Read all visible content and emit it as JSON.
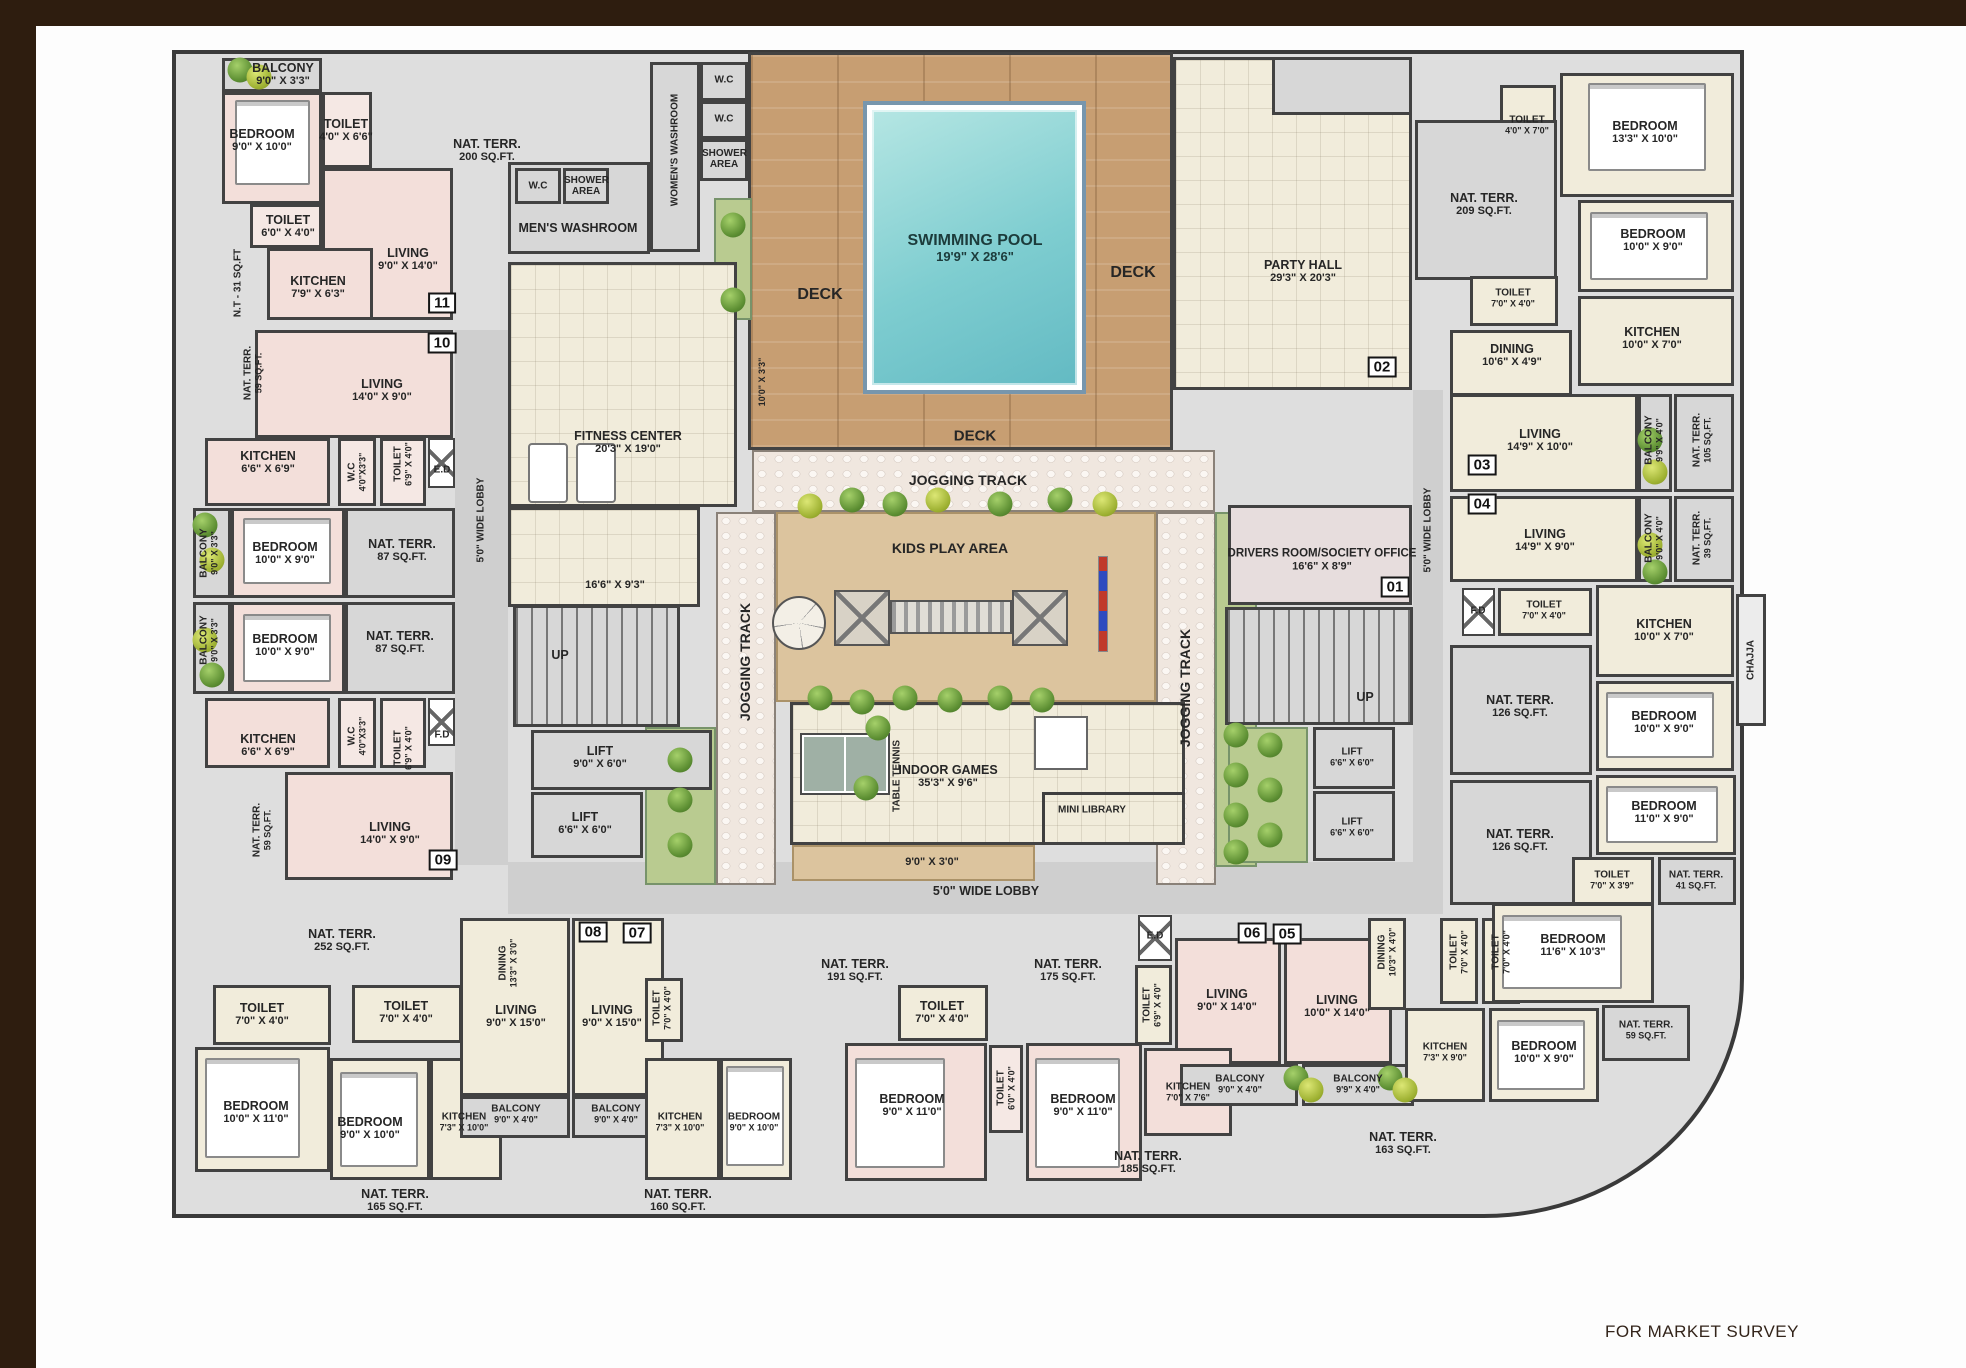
{
  "footer": "FOR MARKET SURVEY",
  "B": [
    "11",
    "10",
    "09",
    "08",
    "07",
    "06",
    "05",
    "04",
    "03",
    "02",
    "01"
  ],
  "L": [
    {
      "t": "BALCONY",
      "d": "9'0\" X 3'3\""
    },
    {
      "t": "BEDROOM",
      "d": "9'0\" X 10'0\""
    },
    {
      "t": "TOILET",
      "d": "4'0\" X 6'6\""
    },
    {
      "t": "NAT. TERR.",
      "d": "200 SQ.FT."
    },
    {
      "t": "W.C",
      "d": ""
    },
    {
      "t": "SHOWER AREA",
      "d": ""
    },
    {
      "t": "MEN'S WASHROOM",
      "d": ""
    },
    {
      "t": "TOILET",
      "d": "6'0\" X 4'0\""
    },
    {
      "t": "KITCHEN",
      "d": "7'9\" X 6'3\""
    },
    {
      "t": "LIVING",
      "d": "9'0\" X 14'0\""
    },
    {
      "t": "N.T - 31 SQ.FT",
      "d": ""
    },
    {
      "t": "WOMEN'S WASHROOM",
      "d": ""
    },
    {
      "t": "W.C",
      "d": ""
    },
    {
      "t": "W.C",
      "d": ""
    },
    {
      "t": "SHOWER AREA",
      "d": ""
    },
    {
      "t": "DECK",
      "d": ""
    },
    {
      "t": "SWIMMING POOL",
      "d": "19'9\" X 28'6\""
    },
    {
      "t": "DECK",
      "d": ""
    },
    {
      "t": "DECK",
      "d": ""
    },
    {
      "t": "PARTY HALL",
      "d": "29'3\" X 20'3\""
    },
    {
      "t": "JOGGING TRACK",
      "d": ""
    },
    {
      "t": "KIDS PLAY AREA",
      "d": ""
    },
    {
      "t": "JOGGING TRACK",
      "d": ""
    },
    {
      "t": "JOGGING TRACK",
      "d": ""
    },
    {
      "t": "FITNESS CENTER",
      "d": "20'3\" X 19'0\""
    },
    {
      "t": "",
      "d": "16'6\" X 9'3\""
    },
    {
      "t": "",
      "d": "10'0\" X 3'3\""
    },
    {
      "t": "5'0\" WIDE LOBBY",
      "d": ""
    },
    {
      "t": "UP",
      "d": ""
    },
    {
      "t": "LIFT",
      "d": "9'0\" X 6'0\""
    },
    {
      "t": "LIFT",
      "d": "6'6\" X 6'0\""
    },
    {
      "t": "TABLE TENNIS",
      "d": ""
    },
    {
      "t": "INDOOR GAMES",
      "d": "35'3\" X 9'6\""
    },
    {
      "t": "MINI LIBRARY",
      "d": ""
    },
    {
      "t": "",
      "d": "9'0\" X 3'0\""
    },
    {
      "t": "5'0\" WIDE LOBBY",
      "d": ""
    },
    {
      "t": "DRIVERS ROOM/SOCIETY OFFICE",
      "d": "16'6\" X 8'9\""
    },
    {
      "t": "UP",
      "d": ""
    },
    {
      "t": "LIFT",
      "d": "6'6\" X 6'0\""
    },
    {
      "t": "LIFT",
      "d": "6'6\" X 6'0\""
    },
    {
      "t": "5'0\" WIDE LOBBY",
      "d": ""
    },
    {
      "t": "NAT. TERR.",
      "d": "59 SQ.FT."
    },
    {
      "t": "LIVING",
      "d": "14'0\" X 9'0\""
    },
    {
      "t": "KITCHEN",
      "d": "6'6\" X 6'9\""
    },
    {
      "t": "W.C",
      "d": "4'0\"X3'3\""
    },
    {
      "t": "TOILET",
      "d": "6'9\" X 4'0\""
    },
    {
      "t": "E.D",
      "d": ""
    },
    {
      "t": "BALCONY",
      "d": "9'0\" X 3'3\""
    },
    {
      "t": "BEDROOM",
      "d": "10'0\" X 9'0\""
    },
    {
      "t": "NAT. TERR.",
      "d": "87 SQ.FT."
    },
    {
      "t": "BALCONY",
      "d": "9'0\" X 3'3\""
    },
    {
      "t": "BEDROOM",
      "d": "10'0\" X 9'0\""
    },
    {
      "t": "NAT. TERR.",
      "d": "87 SQ.FT."
    },
    {
      "t": "KITCHEN",
      "d": "6'6\" X 6'9\""
    },
    {
      "t": "W.C",
      "d": "4'0\"X3'3\""
    },
    {
      "t": "TOILET",
      "d": "6'9\" X 4'0\""
    },
    {
      "t": "F.D",
      "d": ""
    },
    {
      "t": "NAT. TERR.",
      "d": "59 SQ.FT."
    },
    {
      "t": "LIVING",
      "d": "14'0\" X 9'0\""
    },
    {
      "t": "NAT. TERR.",
      "d": "252 SQ.FT."
    },
    {
      "t": "TOILET",
      "d": "7'0\" X 4'0\""
    },
    {
      "t": "TOILET",
      "d": "7'0\" X 4'0\""
    },
    {
      "t": "BEDROOM",
      "d": "10'0\" X 11'0\""
    },
    {
      "t": "BEDROOM",
      "d": "9'0\" X 10'0\""
    },
    {
      "t": "KITCHEN",
      "d": "7'3\" X 10'0\""
    },
    {
      "t": "NAT. TERR.",
      "d": "165 SQ.FT."
    },
    {
      "t": "DINING",
      "d": "13'3\" X 3'0\""
    },
    {
      "t": "LIVING",
      "d": "9'0\" X 15'0\""
    },
    {
      "t": "LIVING",
      "d": "9'0\" X 15'0\""
    },
    {
      "t": "BALCONY",
      "d": "9'0\" X 4'0\""
    },
    {
      "t": "BALCONY",
      "d": "9'0\" X 4'0\""
    },
    {
      "t": "NAT. TERR.",
      "d": "160 SQ.FT."
    },
    {
      "t": "TOILET",
      "d": "7'0\" X 4'0\""
    },
    {
      "t": "KITCHEN",
      "d": "7'3\" X 10'0\""
    },
    {
      "t": "BEDROOM",
      "d": "9'0\" X 10'0\""
    },
    {
      "t": "NAT. TERR.",
      "d": "191 SQ.FT."
    },
    {
      "t": "NAT. TERR.",
      "d": "175 SQ.FT."
    },
    {
      "t": "TOILET",
      "d": "7'0\" X 4'0\""
    },
    {
      "t": "E.D",
      "d": ""
    },
    {
      "t": "TOILET",
      "d": "6'9\" X 4'0\""
    },
    {
      "t": "LIVING",
      "d": "9'0\" X 14'0\""
    },
    {
      "t": "LIVING",
      "d": "10'0\" X 14'0\""
    },
    {
      "t": "BEDROOM",
      "d": "9'0\" X 11'0\""
    },
    {
      "t": "TOILET",
      "d": "6'0\" X 4'0\""
    },
    {
      "t": "BEDROOM",
      "d": "9'0\" X 11'0\""
    },
    {
      "t": "KITCHEN",
      "d": "7'0\" X 7'6\""
    },
    {
      "t": "BALCONY",
      "d": "9'0\" X 4'0\""
    },
    {
      "t": "BALCONY",
      "d": "9'9\" X 4'0\""
    },
    {
      "t": "NAT. TERR.",
      "d": "185 SQ.FT."
    },
    {
      "t": "DINING",
      "d": "10'3\" X 4'0\""
    },
    {
      "t": "TOILET",
      "d": "7'0\" X 4'0\""
    },
    {
      "t": "TOILET",
      "d": "7'0\" X 4'0\""
    },
    {
      "t": "BEDROOM",
      "d": "11'6\" X 10'3\""
    },
    {
      "t": "KITCHEN",
      "d": "7'3\" X 9'0\""
    },
    {
      "t": "BEDROOM",
      "d": "10'0\" X 9'0\""
    },
    {
      "t": "NAT. TERR.",
      "d": "59 SQ.FT."
    },
    {
      "t": "NAT. TERR.",
      "d": "163 SQ.FT."
    },
    {
      "t": "TOILET",
      "d": "4'0\" X 7'0\""
    },
    {
      "t": "BEDROOM",
      "d": "13'3\" X 10'0\""
    },
    {
      "t": "NAT. TERR.",
      "d": "209 SQ.FT."
    },
    {
      "t": "BEDROOM",
      "d": "10'0\" X 9'0\""
    },
    {
      "t": "TOILET",
      "d": "7'0\" X 4'0\""
    },
    {
      "t": "DINING",
      "d": "10'6\" X 4'9\""
    },
    {
      "t": "KITCHEN",
      "d": "10'0\" X 7'0\""
    },
    {
      "t": "LIVING",
      "d": "14'9\" X 10'0\""
    },
    {
      "t": "BALCONY",
      "d": "9'9\" X 4'0\""
    },
    {
      "t": "NAT. TERR.",
      "d": "105 SQ.FT."
    },
    {
      "t": "LIVING",
      "d": "14'9\" X 9'0\""
    },
    {
      "t": "BALCONY",
      "d": "9'0\" X 4'0\""
    },
    {
      "t": "NAT. TERR.",
      "d": "39 SQ.FT."
    },
    {
      "t": "F.D",
      "d": ""
    },
    {
      "t": "TOILET",
      "d": "7'0\" X 4'0\""
    },
    {
      "t": "KITCHEN",
      "d": "10'0\" X 7'0\""
    },
    {
      "t": "CHAJJA",
      "d": ""
    },
    {
      "t": "BEDROOM",
      "d": "10'0\" X 9'0\""
    },
    {
      "t": "NAT. TERR.",
      "d": "126 SQ.FT."
    },
    {
      "t": "NAT. TERR.",
      "d": "126 SQ.FT."
    },
    {
      "t": "BEDROOM",
      "d": "11'0\" X 9'0\""
    },
    {
      "t": "TOILET",
      "d": "7'0\" X 3'9\""
    },
    {
      "t": "NAT. TERR.",
      "d": "41 SQ.FT."
    }
  ]
}
